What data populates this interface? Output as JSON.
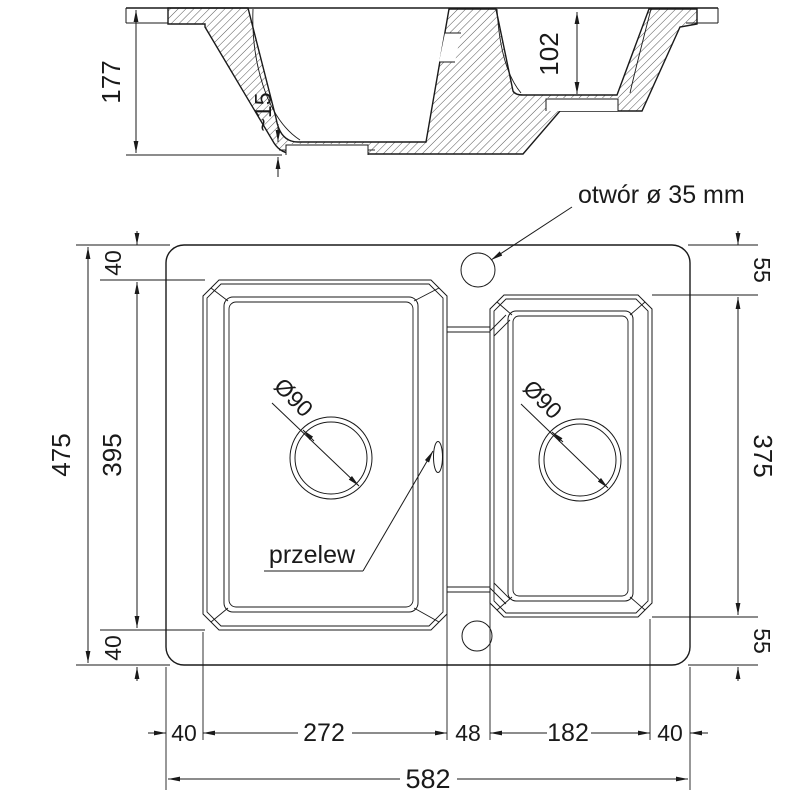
{
  "drawing": {
    "kind": "sink technical drawing",
    "colors": {
      "line": "#1a1a1a",
      "background": "#ffffff"
    },
    "section_view": {
      "total_height": "177",
      "bottom_thickness": "~15",
      "small_bowl_depth": "102"
    },
    "top_view": {
      "faucet_hole_label": "otwór ø 35 mm",
      "overflow_label": "przelew",
      "drain_left_label": "Ø90",
      "drain_right_label": "Ø90",
      "dims_left": {
        "total": "475",
        "top_margin": "40",
        "bowl_height": "395",
        "bottom_margin": "40"
      },
      "dims_right": {
        "top": "55",
        "bowl_height": "375",
        "bottom": "55"
      },
      "dims_bottom": {
        "row1": [
          "40",
          "272",
          "48",
          "182",
          "40"
        ],
        "total": "582"
      }
    }
  }
}
